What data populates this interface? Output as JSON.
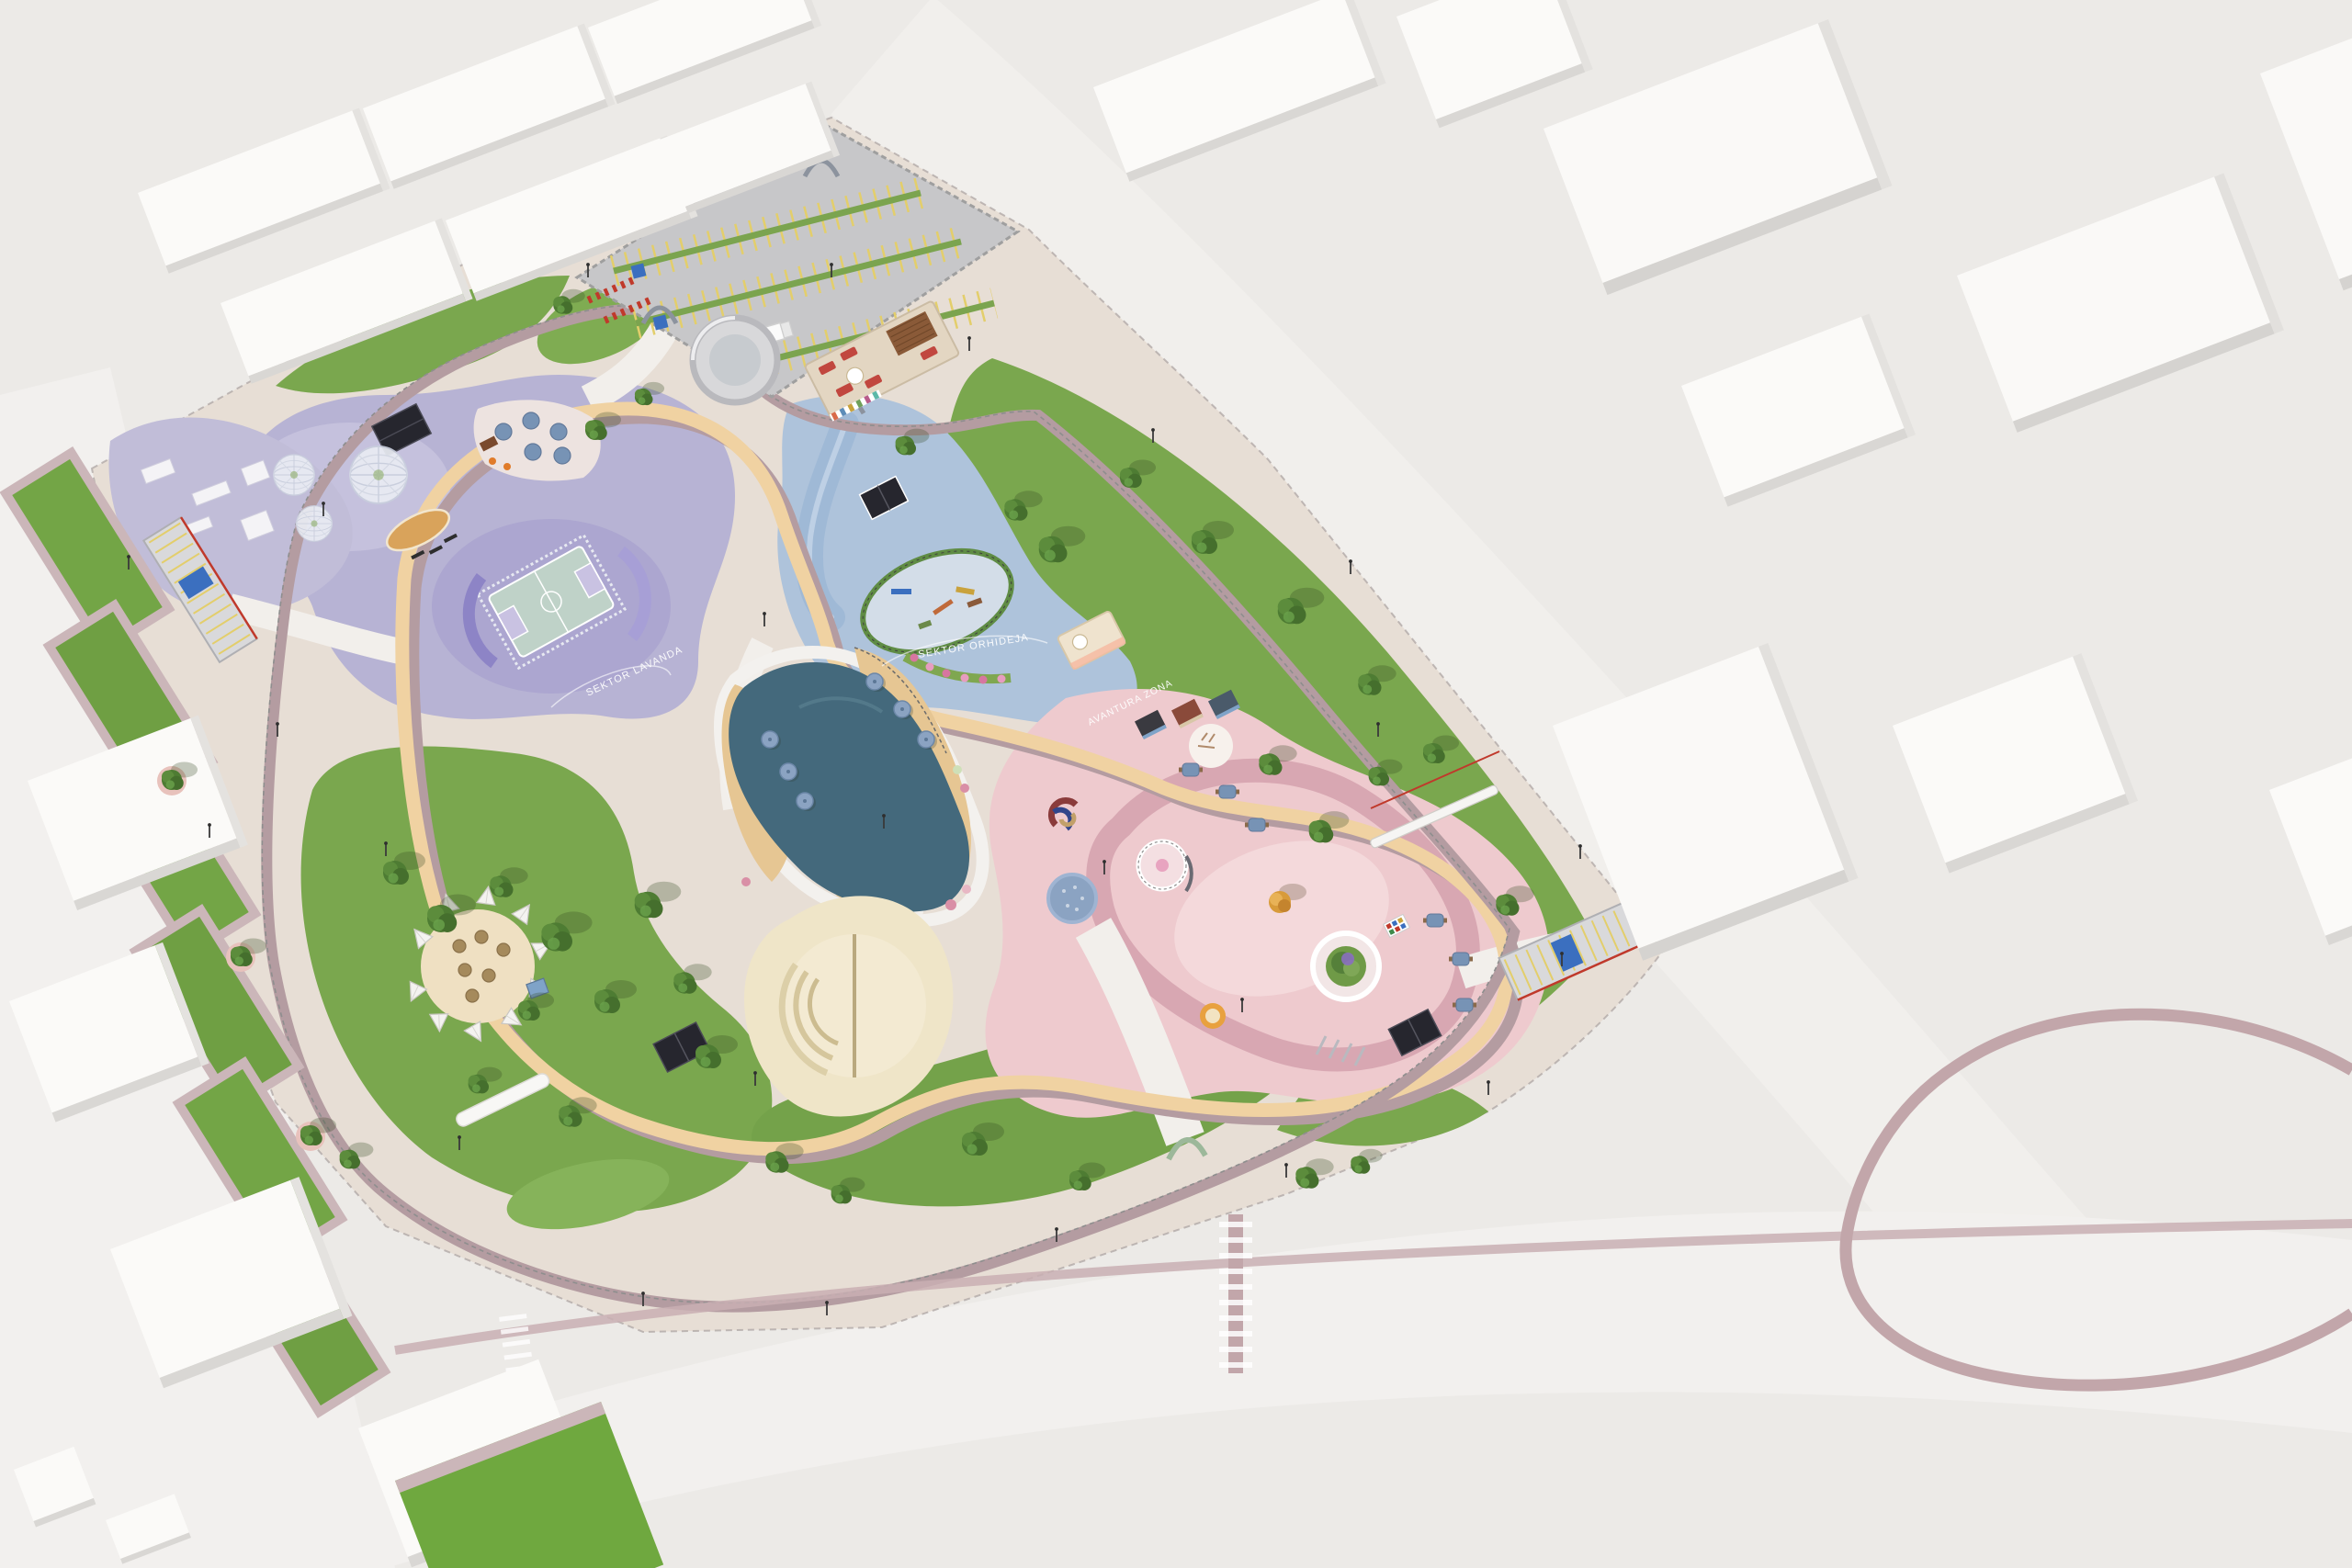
{
  "scene": {
    "description": "Aerial 3D architectural render of a public park masterplan surrounded by white city blocks",
    "ground_labels": {
      "lavender_sector": "SEKTOR LAVANDA",
      "orchid_sector": "SEKTOR ORHIDEJA",
      "adventure_zone": "AVANTURA ZONA"
    },
    "palette": {
      "background": "#ECEAE7",
      "road_white": "#F2F0EE",
      "building_top": "#FBFAF8",
      "building_side": "#DDDAD7",
      "park_paving": "#E7DED5",
      "lawn": "#7AA74E",
      "lawn_dark": "#5F8C3F",
      "path_tan": "#F0D2A2",
      "path_mauve": "#B49CA1",
      "path_white": "#F2EFEB",
      "water": "#44697C",
      "beach_sand": "#E6C693",
      "sector_lavender": "#B7B3D4",
      "sector_lavender_light": "#C8C4DF",
      "sector_blue": "#AEC3DB",
      "sector_blue_light": "#D3DDE8",
      "sector_pink": "#EECACE",
      "sector_pink_deep": "#D8A7B2",
      "parking_asphalt": "#C7C7C9",
      "stall_yellow": "#E3CE6B",
      "bike_red": "#C0392B",
      "umbrella_blue": "#8BA3C2",
      "court_surface": "#BFD2C8",
      "court_seat_purple": "#8D84C6",
      "amphitheater_sand": "#F3EAD2",
      "accessible_blue": "#3B6FBF",
      "hedge_green": "#5F8C44",
      "stage_wood": "#D9A35B",
      "pavilion_black": "#26262E",
      "future_loop_mauve": "#C2A6AA",
      "label_white": "#FFFFFF"
    }
  }
}
